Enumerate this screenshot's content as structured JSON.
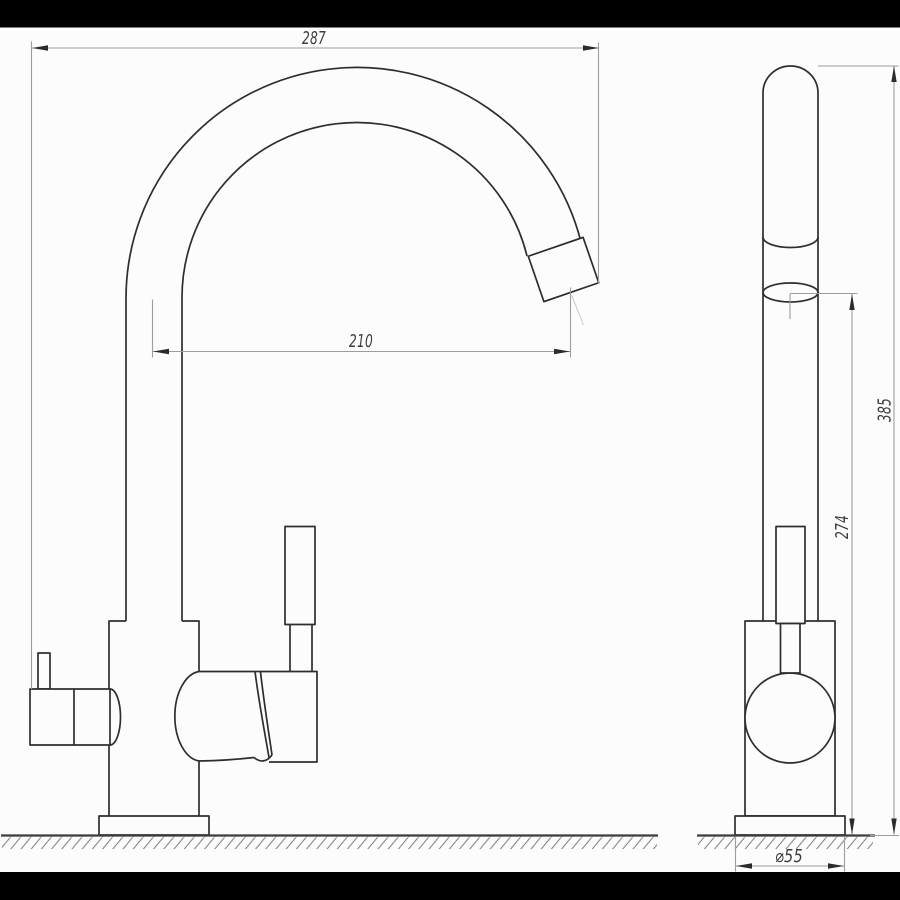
{
  "drawing": {
    "kind": "faucet technical drawing, two orthographic views",
    "colors": {
      "outline": "#2e2e2e",
      "dimension_line": "#9d9d9d",
      "arrowhead": "#2b2b2b",
      "background": "#fcfcfc",
      "letterbox": "#000000",
      "hatch": "#7d7d7d"
    },
    "dimensions": {
      "overall_reach": {
        "label": "287"
      },
      "outlet_reach": {
        "label": "210"
      },
      "overall_height": {
        "label": "385"
      },
      "outlet_height": {
        "label": "274"
      },
      "base_diameter": {
        "label": "⌀55"
      }
    }
  }
}
